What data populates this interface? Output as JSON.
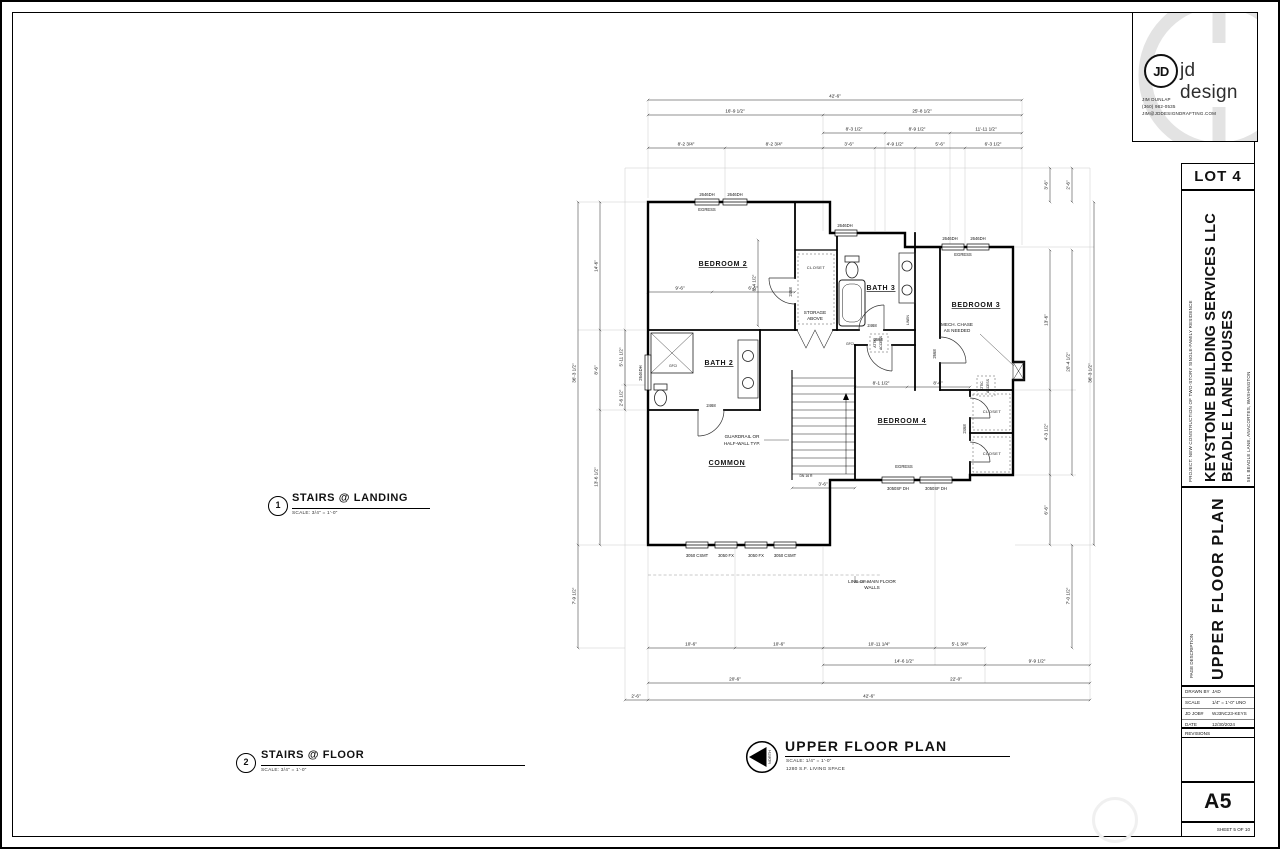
{
  "sheet": {
    "lot": "LOT 4",
    "sheet_number": "A5",
    "sheet_label": "SHEET 5 OF 10"
  },
  "logo": {
    "brand": "jd design",
    "monogram": "JD",
    "contact_name": "JIM DUNLAP",
    "contact_phone": "(360) 982-0535",
    "contact_email": "JIM@JDDESIGNDRAFTING.COM"
  },
  "titleblock": {
    "project_note": "PROJECT: NEW CONSTRUCTION OF TWO-STORY SINGLE-FAMILY RESIDENCE",
    "client_line1": "KEYSTONE BUILDING SERVICES LLC",
    "client_line2": "BEADLE LANE HOUSES",
    "address": "561 BEADLE LANE, ANACORTES, WASHINGTON",
    "page_description_label": "PAGE DESCRIPTION",
    "page_title": "UPPER FLOOR PLAN",
    "drawn_by_label": "DRAWN BY",
    "drawn_by": "JAD",
    "scale_label": "SCALE",
    "scale": "1/4\" = 1'-0\" UNO",
    "job_label": "JD JOB#",
    "job": "WJ3NC23-KEYS",
    "date_label": "DATE",
    "date": "12/30/2024",
    "revisions_label": "REVISIONS"
  },
  "callouts": [
    {
      "number": "1",
      "title": "STAIRS @ LANDING",
      "scale": "SCALE: 3/4\" = 1'-0\""
    },
    {
      "number": "2",
      "title": "STAIRS @ FLOOR",
      "scale": "SCALE: 3/4\" = 1'-0\""
    }
  ],
  "plan_title": {
    "title": "UPPER FLOOR PLAN",
    "scale": "SCALE: 1/4\" = 1'-0\"",
    "area": "1280 S.F. LIVING SPACE",
    "north_label": "NORTH"
  },
  "rooms": {
    "bedroom2": "BEDROOM 2",
    "bath2": "BATH 2",
    "common": "COMMON",
    "bath3": "BATH 3",
    "bedroom3": "BEDROOM 3",
    "bedroom4": "BEDROOM 4",
    "closet": "CLOSET"
  },
  "notes": {
    "egress": "EGRESS",
    "storage1": "STORAGE",
    "storage2": "ABOVE",
    "attic1": "ATTIC",
    "attic2": "ACCESS",
    "mech1": "MECH. CHASE",
    "mech2": "AS NEEDED",
    "guard1": "GUARDRAIL OR",
    "guard2": "HALF-WALL TYP.",
    "dn": "DN 16 R",
    "linen": "LINEN",
    "main1": "LINE OF MAIN FLOOR",
    "main2": "WALLS",
    "gfci": "GFCI"
  },
  "tags": {
    "dh": "2646DH",
    "csmt": "3050 CSMT",
    "fx": "3050 FX",
    "sfdh": "3050SF DH",
    "d2468": "2468",
    "d2668": "2668"
  },
  "dims": {
    "top": [
      "42'-6\"",
      "16'-9 1/2\"",
      "25'-8 1/2\"",
      "8'-3 1/2\"",
      "8'-9 1/2\"",
      "11'-11 1/2\"",
      "8'-2 3/4\"",
      "8'-2 3/4\"",
      "3'-6\"",
      "4'-9 1/2\"",
      "5'-6\"",
      "6'-3 1/2\""
    ],
    "bottom": [
      "10'-6\"",
      "10'-6\"",
      "10'-11 1/4\"",
      "5'-1 3/4\"",
      "14'-6 1/2\"",
      "9'-9 1/2\"",
      "20'-6\"",
      "22'-0\"",
      "2'-6\"",
      "42'-6\""
    ],
    "left": [
      "14'-6\"",
      "8'-6\"",
      "13'-6 1/2\"",
      "5'-11 1/2\"",
      "2'-6 1/2\"",
      "36'-3 1/2\"",
      "7'-9 1/2\""
    ],
    "right": [
      "3'-6\"",
      "2'-6\"",
      "13'-6\"",
      "4'-3 1/2\"",
      "6'-6\"",
      "20'-4 1/2\"",
      "7'-0 1/2\"",
      "36'-3 1/2\""
    ],
    "interior": [
      "9'-6\"",
      "6'-6\"",
      "8'-4 1/2\"",
      "3'-6\"",
      "8'-1 1/2\"",
      "8'-6\""
    ]
  }
}
